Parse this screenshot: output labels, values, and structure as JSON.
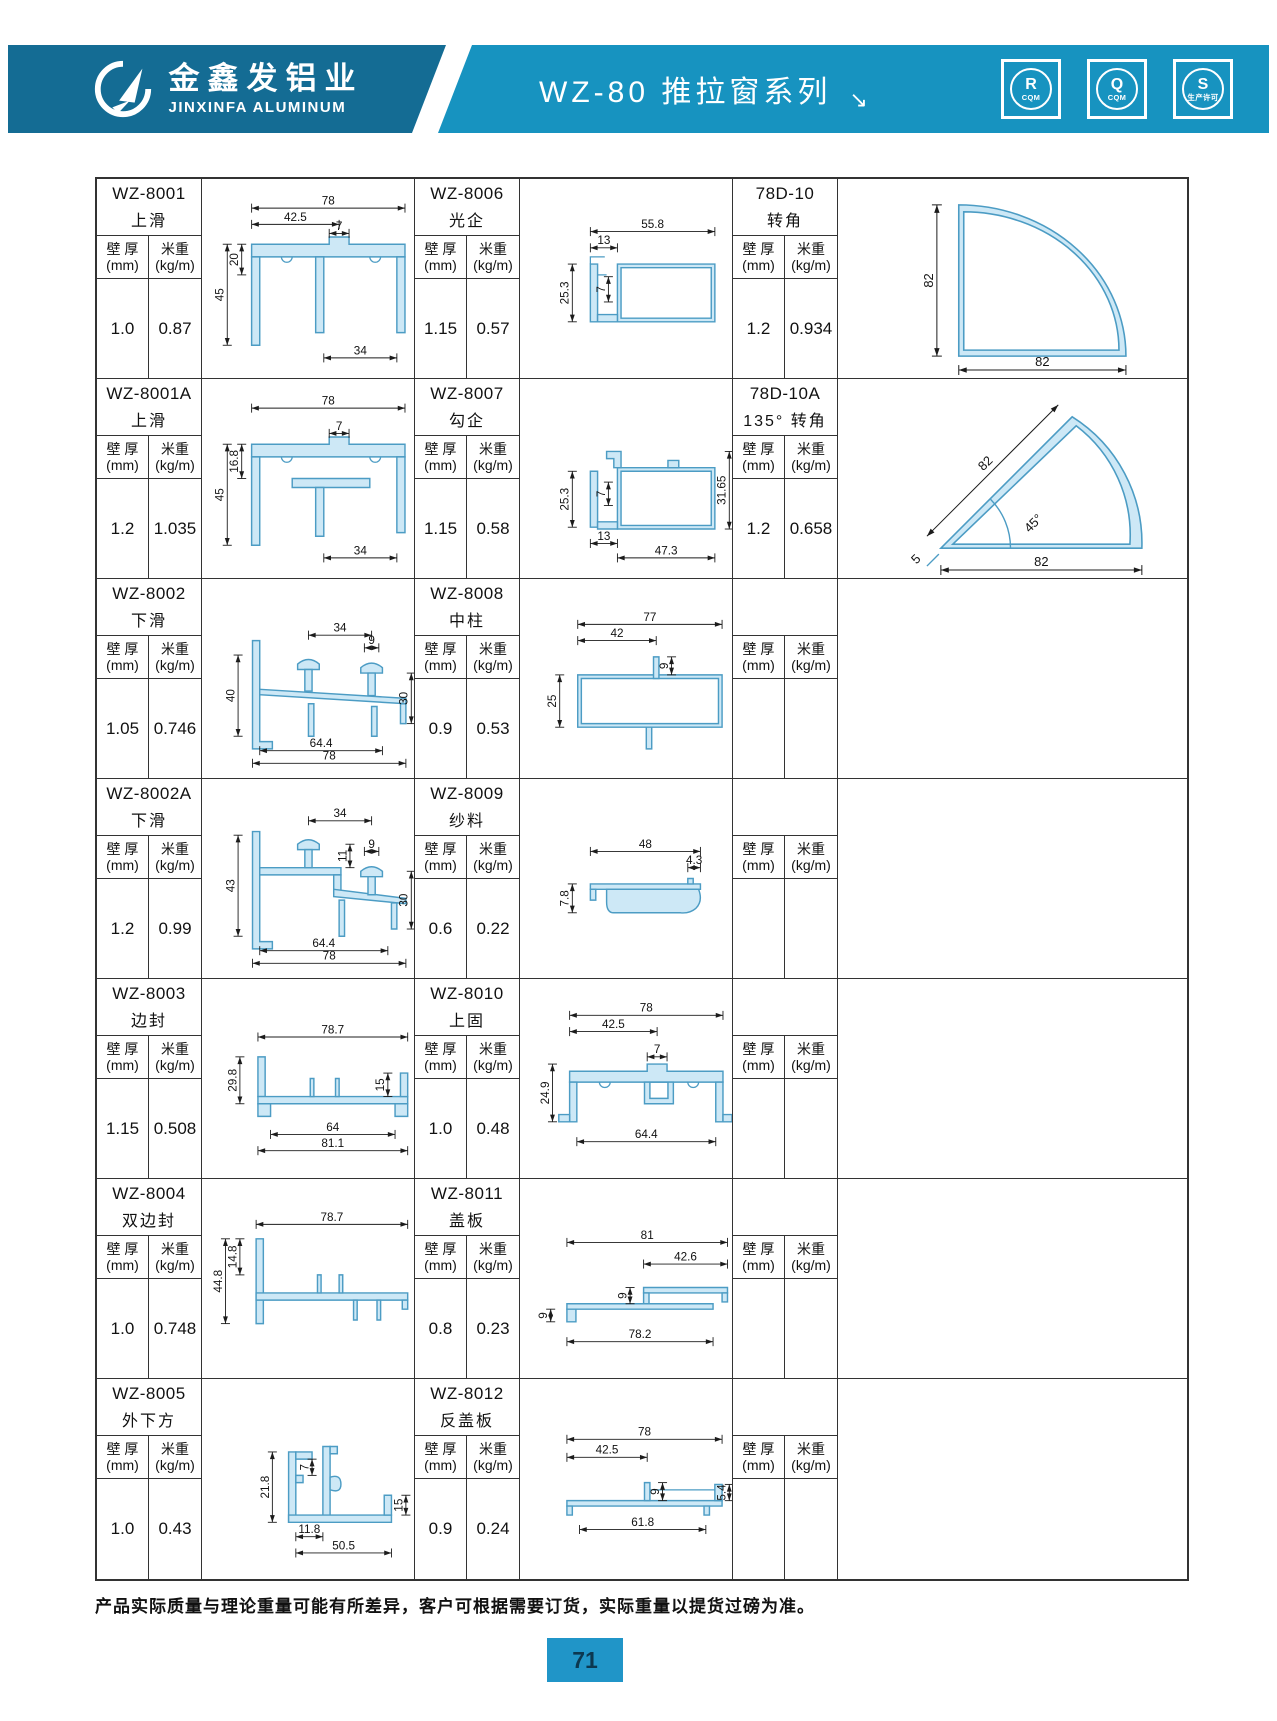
{
  "header": {
    "brand_cn": "金鑫发铝业",
    "brand_en": "JINXINFA ALUMINUM",
    "series_title": "WZ-80 推拉窗系列",
    "title_arrow": "↘",
    "certs": [
      {
        "letter": "R",
        "sub": "CQM"
      },
      {
        "letter": "Q",
        "sub": "CQM"
      },
      {
        "letter": "S",
        "sub": "生产许可"
      }
    ]
  },
  "labels": {
    "wall": "壁 厚",
    "wall_unit": "(mm)",
    "weight": "米重",
    "weight_unit": "(kg/m)"
  },
  "products": {
    "wz8001": {
      "code": "WZ-8001",
      "name": "上滑",
      "wall": "1.0",
      "weight": "0.87",
      "dims": [
        "78",
        "42.5",
        "7",
        "20",
        "45",
        "34"
      ]
    },
    "wz8001a": {
      "code": "WZ-8001A",
      "name": "上滑",
      "wall": "1.2",
      "weight": "1.035",
      "dims": [
        "78",
        "7",
        "16.8",
        "45",
        "34"
      ]
    },
    "wz8002": {
      "code": "WZ-8002",
      "name": "下滑",
      "wall": "1.05",
      "weight": "0.746",
      "dims": [
        "34",
        "9",
        "40",
        "30",
        "64.4",
        "78"
      ]
    },
    "wz8002a": {
      "code": "WZ-8002A",
      "name": "下滑",
      "wall": "1.2",
      "weight": "0.99",
      "dims": [
        "34",
        "11",
        "9",
        "43",
        "30",
        "64.4",
        "78"
      ]
    },
    "wz8003": {
      "code": "WZ-8003",
      "name": "边封",
      "wall": "1.15",
      "weight": "0.508",
      "dims": [
        "78.7",
        "29.8",
        "15",
        "64",
        "81.1"
      ]
    },
    "wz8004": {
      "code": "WZ-8004",
      "name": "双边封",
      "wall": "1.0",
      "weight": "0.748",
      "dims": [
        "78.7",
        "44.8",
        "14.8"
      ]
    },
    "wz8005": {
      "code": "WZ-8005",
      "name": "外下方",
      "wall": "1.0",
      "weight": "0.43",
      "dims": [
        "21.8",
        "7",
        "15",
        "11.8",
        "50.5"
      ]
    },
    "wz8006": {
      "code": "WZ-8006",
      "name": "光企",
      "wall": "1.15",
      "weight": "0.57",
      "dims": [
        "55.8",
        "13",
        "25.3",
        "7"
      ]
    },
    "wz8007": {
      "code": "WZ-8007",
      "name": "勾企",
      "wall": "1.15",
      "weight": "0.58",
      "dims": [
        "25.3",
        "7",
        "31.65",
        "13",
        "47.3"
      ]
    },
    "wz8008": {
      "code": "WZ-8008",
      "name": "中柱",
      "wall": "0.9",
      "weight": "0.53",
      "dims": [
        "77",
        "42",
        "9",
        "25"
      ]
    },
    "wz8009": {
      "code": "WZ-8009",
      "name": "纱料",
      "wall": "0.6",
      "weight": "0.22",
      "dims": [
        "48",
        "4.3",
        "7.8"
      ]
    },
    "wz8010": {
      "code": "WZ-8010",
      "name": "上固",
      "wall": "1.0",
      "weight": "0.48",
      "dims": [
        "78",
        "42.5",
        "7",
        "24.9",
        "64.4"
      ]
    },
    "wz8011": {
      "code": "WZ-8011",
      "name": "盖板",
      "wall": "0.8",
      "weight": "0.23",
      "dims": [
        "81",
        "42.6",
        "9",
        "9",
        "78.2"
      ]
    },
    "wz8012": {
      "code": "WZ-8012",
      "name": "反盖板",
      "wall": "0.9",
      "weight": "0.24",
      "dims": [
        "78",
        "42.5",
        "9",
        "5.4",
        "61.8"
      ]
    },
    "d7810": {
      "code": "78D-10",
      "name": "转角",
      "wall": "1.2",
      "weight": "0.934",
      "dims": [
        "82",
        "82"
      ]
    },
    "d7810a": {
      "code": "78D-10A",
      "name": "135° 转角",
      "wall": "1.2",
      "weight": "0.658",
      "dims": [
        "82",
        "45°",
        "5",
        "82"
      ]
    },
    "empty": {
      "code": "",
      "name": "",
      "wall": "",
      "weight": "",
      "dims": []
    }
  },
  "footer": {
    "note": "产品实际质量与理论重量可能有所差异，客户可根据需要订货，实际重量以提货过磅为准。",
    "page": "71"
  },
  "colors": {
    "band_dark": "#146c94",
    "band_light": "#1793c0",
    "profile_fill": "#cde8f6",
    "profile_stroke": "#4c9cc4",
    "page_box_blue": "#2095c8"
  }
}
